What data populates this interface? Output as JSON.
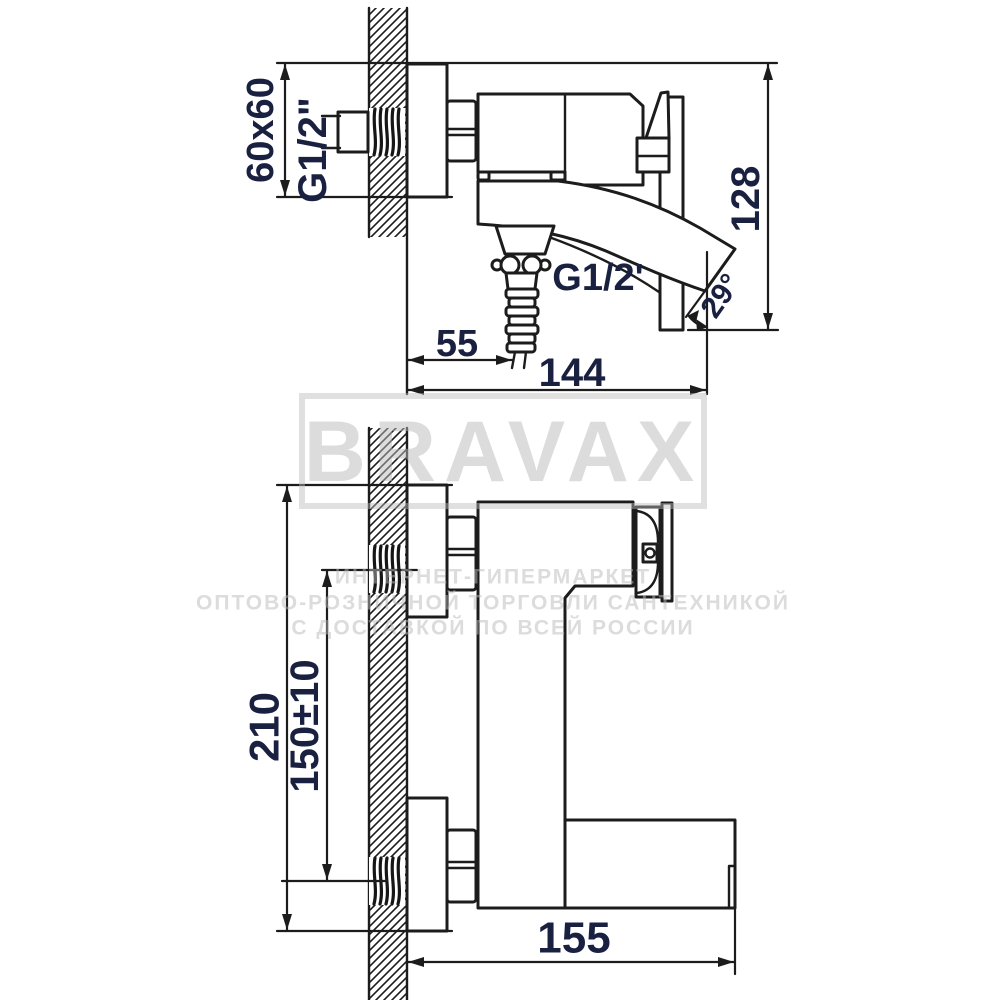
{
  "page": {
    "background": "#ffffff"
  },
  "colors": {
    "line": "#1c1c1c",
    "dim_text": "#1a2140",
    "watermark": "#bababa"
  },
  "watermark": {
    "brand": "BRAVAX",
    "tagline_line1": "ИНТЕРНЕТ-ГИПЕРМАРКЕТ",
    "tagline_line2": "ОПТОВО-РОЗНИЧНОЙ ТОРГОВЛИ САНТЕХНИКОЙ",
    "tagline_line3": "С ДОСТАВКОЙ ПО ВСЕЙ РОССИИ"
  },
  "side_view": {
    "labels": {
      "plate_size": "60x60",
      "wall_thread": "G1/2\"",
      "hose_thread": "G1/2'",
      "spout_angle": "29°",
      "hose_offset": "55",
      "spout_reach": "144",
      "overall_height": "128"
    }
  },
  "plan_view": {
    "labels": {
      "overall_length": "210",
      "inlet_spacing": "150±10",
      "spout_reach": "155"
    }
  }
}
